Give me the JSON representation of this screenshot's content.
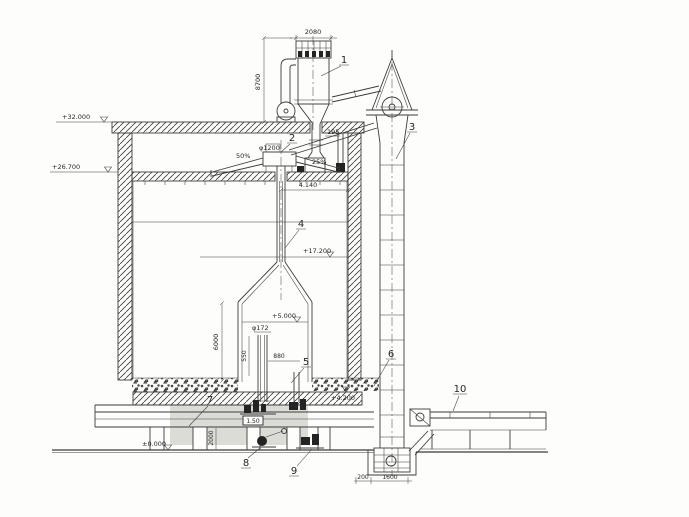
{
  "drawing": {
    "type": "engineering-section",
    "subject": "silo with cyclone, rotary distributor, bucket elevator and conveyors",
    "colors": {
      "line": "#3c3c3c",
      "paper": "#fdfdfb",
      "tunnel_wash": "#cdcdc8"
    }
  },
  "part_labels": {
    "p1": "1",
    "p2": "2",
    "p3": "3",
    "p4": "4",
    "p5": "5",
    "p6": "6",
    "p7": "7",
    "p8": "8",
    "p9": "9",
    "p10": "10"
  },
  "elevations": {
    "roof": "+32.000",
    "distributor_floor": "+26.700",
    "mid_level": "+17.200",
    "cone_level": "+5.000",
    "material_level": "+4.200",
    "ground": "±0.000"
  },
  "dimensions": {
    "top_width": "2080",
    "stack_height": "8700",
    "distributor_dia": "φ1200",
    "slope_left": "50%",
    "slope_right": "25%",
    "chute": "195",
    "pipe_offset": "4.140",
    "inner_pipe_dia": "φ172",
    "pipe_gap": "550",
    "outlet": "880",
    "cone_height": "6000",
    "tunnel_height": "2000",
    "belt": "1.50",
    "boot_a": "200",
    "boot_b": "1600"
  }
}
